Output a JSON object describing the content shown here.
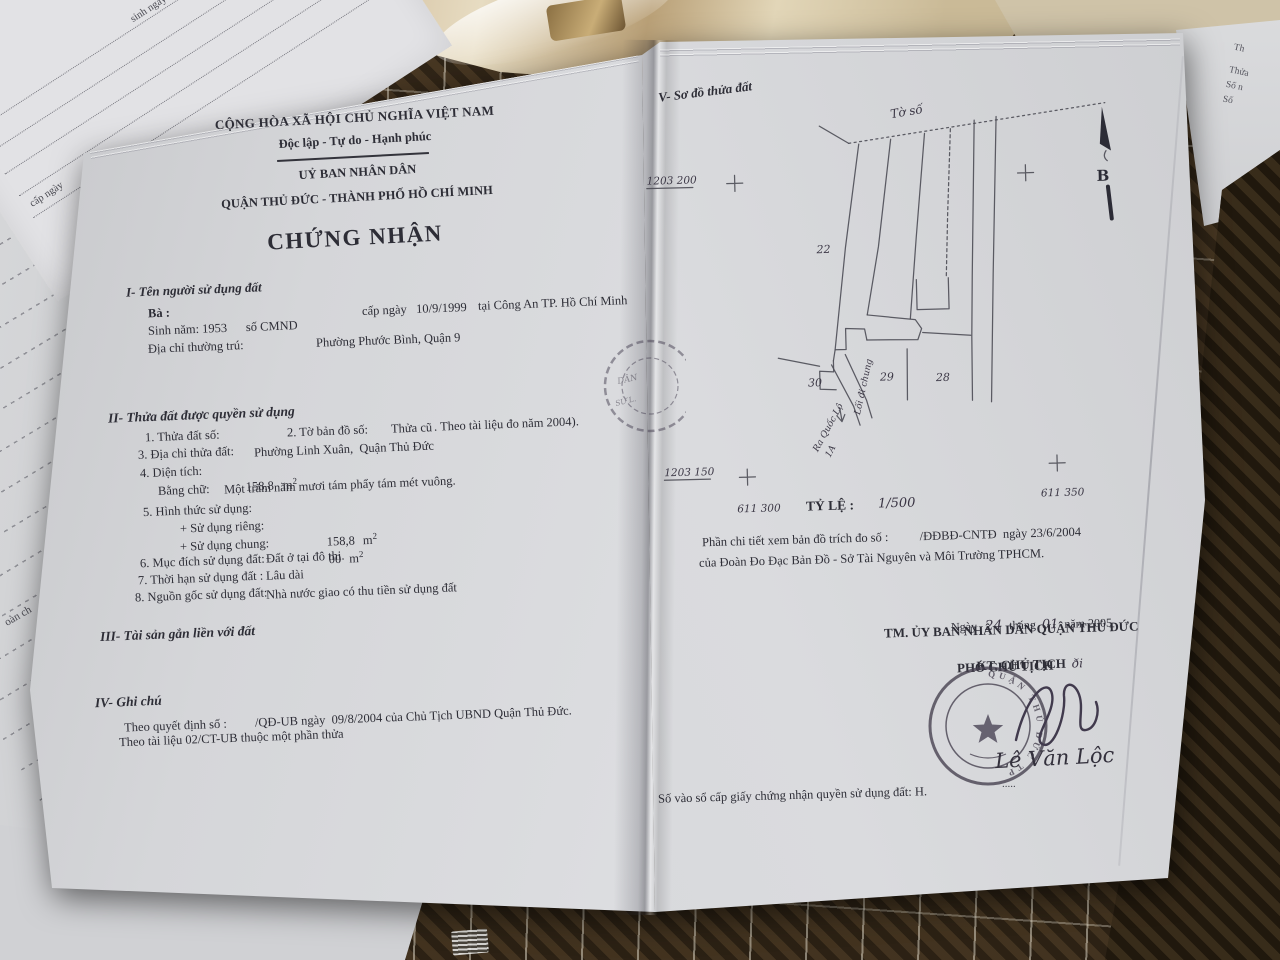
{
  "background": {
    "top_left_form": {
      "fragment": "CHẤP",
      "label_birth": "sinh ngày",
      "label_at": "Tại",
      "label_issue": "cấp ngày"
    },
    "left_strip_fragment": "oàn ch",
    "right_page_fragments": [
      "Th",
      "Thửa",
      "Số n",
      "Số"
    ]
  },
  "left_page": {
    "header": {
      "country": "CỘNG HÒA XÃ HỘI CHỦ NGHĨA VIỆT NAM",
      "motto": "Độc lập - Tự do - Hạnh phúc",
      "issuer1": "UỶ BAN NHÂN DÂN",
      "issuer2": "QUẬN THỦ ĐỨC - THÀNH PHỐ HỒ CHÍ MINH",
      "title": "CHỨNG NHẬN"
    },
    "section1": {
      "heading": "I- Tên người sử dụng đất",
      "holder": "Bà :",
      "id_issue": "cấp ngày   10/9/1999",
      "id_place": "tại Công An TP. Hồ Chí Minh",
      "birth_id": "Sinh năm: 1953      số CMND",
      "addr_label": "Địa chỉ thường trú:",
      "addr_value": "Phường Phước Bình, Quận 9"
    },
    "section2": {
      "heading": "II- Thửa đất được quyền sử dụng",
      "i1": "1. Thửa đất số:",
      "i2": "2. Tờ bản đồ số:",
      "i2a": "Thửa cũ",
      "i2b": ". Theo tài liệu đo năm 2004).",
      "i3": "3. Địa chỉ thửa đất:",
      "i3v": "Phường Linh Xuân,  Quận Thủ Đức",
      "i4": "4. Diện tích:",
      "i4v": "158,8",
      "unit": "m",
      "sup": "2",
      "words_label": "Bằng chữ:",
      "words_value": "Một trăm năm mươi tám phẩy tám mét vuông.",
      "i5": "5. Hình thức sử dụng:",
      "priv_label": "+ Sử dụng riêng:",
      "priv_value": "158,8",
      "shared_label": "+ Sử dụng chung:",
      "shared_value": "00",
      "i6": "6. Mục đích sử dụng đất:",
      "i6v": "Đất ở tại đô thị.",
      "i7": "7. Thời hạn sử dụng đất :",
      "i7v": "Lâu dài",
      "i8": "8. Nguồn gốc sử dụng đất:",
      "i8v": "Nhà nước giao có thu tiền sử dụng đất"
    },
    "section3_heading": "III- Tài sản gắn liền với đất",
    "section4": {
      "heading": "IV- Ghi chú",
      "note1": "Theo quyết định số :         /QĐ-UB ngày  09/8/2004 của Chủ Tịch UBND Quận Thủ Đức.",
      "note2": "Theo tài liệu 02/CT-UB thuộc một phần thửa"
    },
    "fold_stamp": {
      "frag1": "DÂN",
      "frag2": "SỬ L."
    }
  },
  "right_page": {
    "map_heading": "V- Sơ đồ thửa đất",
    "map": {
      "sheet_label": "Tờ số",
      "parcel_22": "22",
      "parcel_30": "30",
      "parcel_29": "29",
      "parcel_28": "28",
      "path_label": "Lối đi chung",
      "road_label_1": "Ra Quốc Lộ",
      "road_label_2": "1A",
      "north_label": "B",
      "coord_top_left": "1203 200",
      "coord_bottom_left": "1203 150",
      "coord_left": "611 300",
      "coord_right": "611 350"
    },
    "scale_label": "TỶ LỆ :",
    "scale_value": "1/500",
    "detail_note1": "Phần chi tiết xem bản đồ trích đo số :          /ĐĐBĐ-CNTĐ  ngày 23/6/2004",
    "detail_note2": "của Đoàn Đo Đạc Bản Đồ - Sở Tài Nguyên và Môi Trường TPHCM.",
    "signature": {
      "date_prefix": "Ngày",
      "date_day": "24",
      "date_mid": "tháng",
      "date_month": "01",
      "date_suffix": "năm 2005",
      "line1": "TM. ỦY BAN NHÂN DÂN QUẬN THỦ ĐỨC",
      "line2": "KT. CHỦ TỊCH",
      "scribble": "ði",
      "line3": "PHÓ CHỦ TỊCH",
      "stamp_text": "QUẬN THỦ ĐỨC TP",
      "signer": "Lê Văn Lộc",
      "dots": "....."
    },
    "registry_line": "Số vào sổ cấp giấy chứng nhận quyền sử dụng đất: H."
  }
}
